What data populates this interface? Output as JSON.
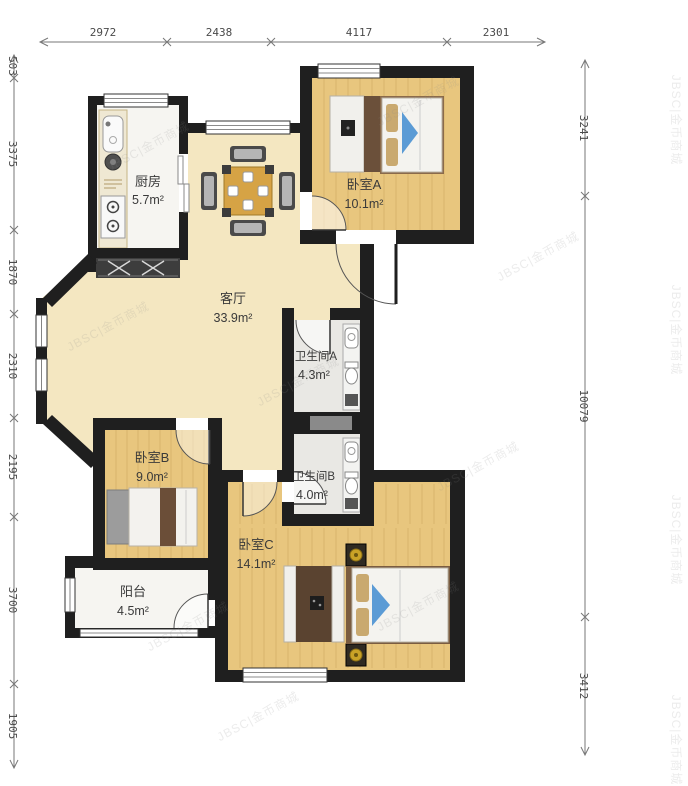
{
  "watermark": {
    "text": "JBSC|金币商城"
  },
  "dimensions": {
    "top": [
      "2972",
      "2438",
      "4117",
      "2301"
    ],
    "left": [
      "503",
      "3375",
      "1870",
      "2310",
      "2195",
      "3700",
      "1905"
    ],
    "right": [
      "3241",
      "10079",
      "3412"
    ]
  },
  "rooms": {
    "kitchen": {
      "name": "厨房",
      "area": "5.7m²"
    },
    "bedroom_a": {
      "name": "卧室A",
      "area": "10.1m²"
    },
    "living": {
      "name": "客厅",
      "area": "33.9m²"
    },
    "bath_a": {
      "name": "卫生间A",
      "area": "4.3m²"
    },
    "bath_b": {
      "name": "卫生间B",
      "area": "4.0m²"
    },
    "bedroom_b": {
      "name": "卧室B",
      "area": "9.0m²"
    },
    "bedroom_c": {
      "name": "卧室C",
      "area": "14.1m²"
    },
    "balcony": {
      "name": "阳台",
      "area": "4.5m²"
    }
  },
  "colors": {
    "wall": "#1f1f1f",
    "wood_floor": "#e8c67e",
    "living_floor": "#f4e7c1",
    "bath_floor": "#e9e8e4",
    "white_floor": "#f6f5f1",
    "accent_blue": "#5b9bd5"
  }
}
